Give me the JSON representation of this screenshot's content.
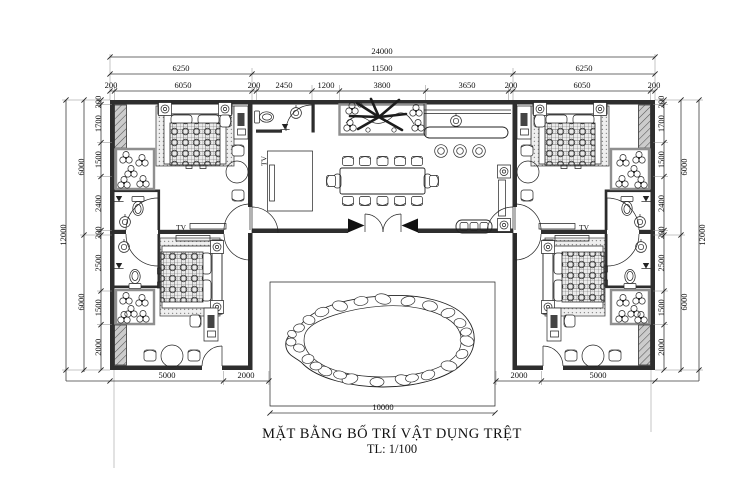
{
  "title": {
    "line1": "MẶT BẰNG BỐ TRÍ VẬT DỤNG TRỆT",
    "line2": "TL: 1/100"
  },
  "labels": {
    "tv": "TV"
  },
  "colors": {
    "line": "#222222",
    "wall": "#2e2e2e",
    "planter_border": "#8f8f8f",
    "paper": "#ffffff"
  },
  "dimensions": {
    "overall_width": "24000",
    "top_sections": [
      "6250",
      "11500",
      "6250"
    ],
    "top_detail": [
      "200",
      "6050",
      "200",
      "2450",
      "1200",
      "3800",
      "3650",
      "200",
      "6050",
      "200"
    ],
    "left_overall": "12000",
    "left_halves": [
      "6000",
      "6000"
    ],
    "left_detail": [
      "200",
      "1700",
      "1500",
      "2400",
      "200",
      "2500",
      "1500",
      "2000"
    ],
    "right_overall": "12000",
    "right_halves": [
      "6000",
      "6000"
    ],
    "right_detail": [
      "200",
      "1700",
      "1500",
      "2400",
      "200",
      "2500",
      "1500",
      "2000"
    ],
    "bottom_left": [
      "5000",
      "2000"
    ],
    "bottom_right": [
      "2000",
      "5000"
    ],
    "pool_width": "10000"
  }
}
